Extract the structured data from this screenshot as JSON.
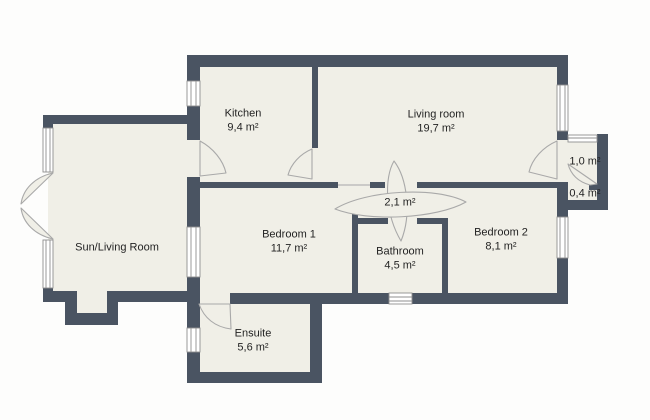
{
  "title": "Apartment floor plan",
  "colors": {
    "wall": "#4a5462",
    "floor": "#f0efe7",
    "background": "#fdfdfc",
    "window_fill": "#ffffff",
    "window_stroke": "#8f8f8f",
    "door_stroke": "#a9a9a9",
    "text": "#232323"
  },
  "rooms": [
    {
      "id": "kitchen",
      "name": "Kitchen",
      "area": "9,4 m²"
    },
    {
      "id": "living-room",
      "name": "Living room",
      "area": "19,7 m²"
    },
    {
      "id": "sun-living-room",
      "name": "Sun/Living Room",
      "area": ""
    },
    {
      "id": "bedroom-1",
      "name": "Bedroom 1",
      "area": "11,7 m²"
    },
    {
      "id": "bathroom",
      "name": "Bathroom",
      "area": "4,5 m²"
    },
    {
      "id": "bedroom-2",
      "name": "Bedroom 2",
      "area": "8,1 m²"
    },
    {
      "id": "ensuite",
      "name": "Ensuite",
      "area": "5,6 m²"
    },
    {
      "id": "hallway",
      "name": "",
      "area": "2,1 m²"
    },
    {
      "id": "balcony",
      "name": "",
      "area": "1,0 m²"
    },
    {
      "id": "closet",
      "name": "",
      "area": "0,4 m²"
    }
  ]
}
